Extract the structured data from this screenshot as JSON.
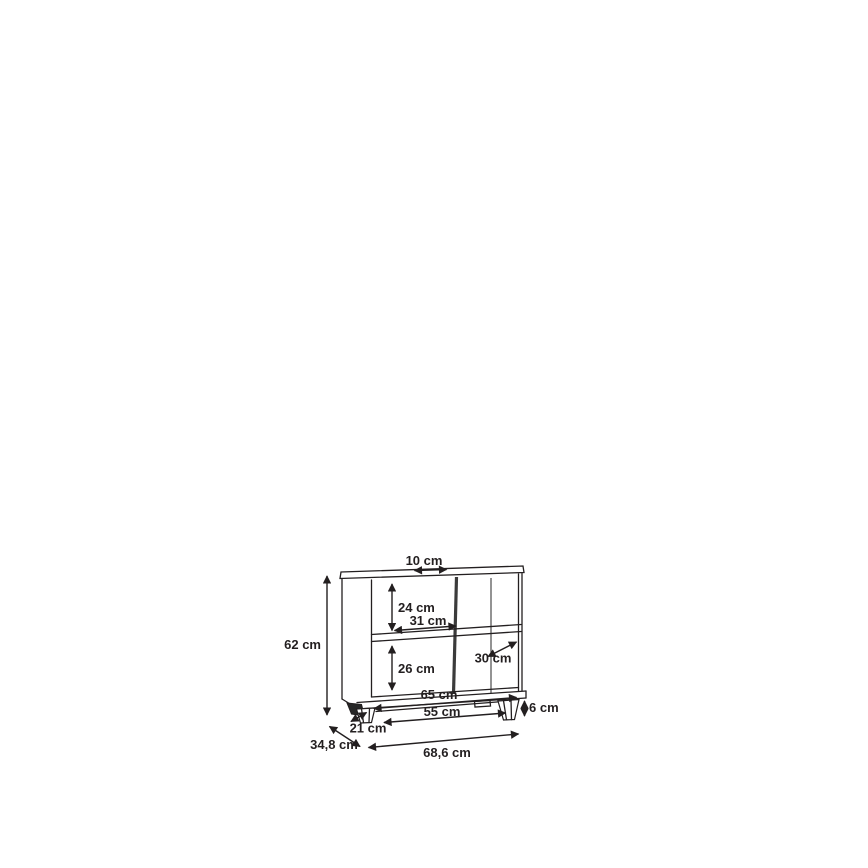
{
  "diagram": {
    "type": "furniture-dimension-drawing",
    "labels": {
      "top_depth": "10 cm",
      "height": "62 cm",
      "upper_compartment_height": "24 cm",
      "upper_compartment_width": "31 cm",
      "lower_compartment_height": "26 cm",
      "compartment_depth": "30 cm",
      "bottom_inner_width": "65 cm",
      "foot_span_width": "55 cm",
      "foot_height": "6 cm",
      "foot_depth": "21 cm",
      "depth": "34,8 cm",
      "width": "68,6 cm"
    },
    "colors": {
      "line": "#231f20",
      "divider": "#3b3b3b",
      "background": "#ffffff"
    }
  }
}
